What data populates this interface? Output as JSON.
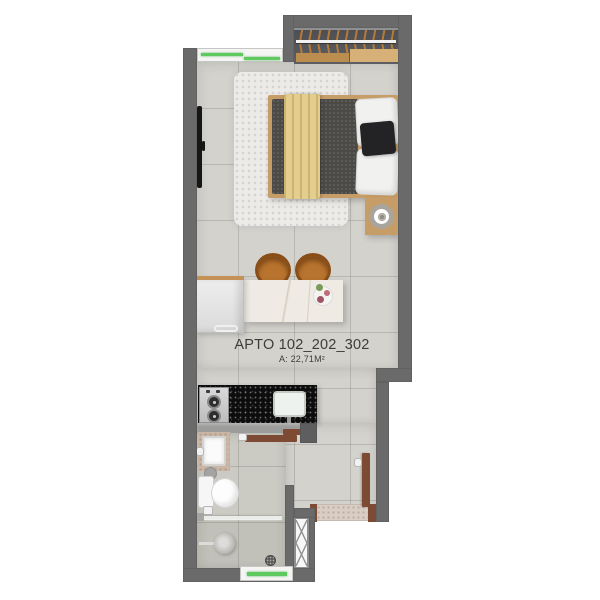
{
  "plan": {
    "type": "apartment-floor-plan",
    "labels": {
      "apartment": "APTO 102_202_302",
      "area": "A: 22,71M²"
    },
    "colors": {
      "wall": "#6a6a6a",
      "floor": "#d4d2cd",
      "bathroom_floor": "#cbcac3",
      "window_glass_green": "#5ec95e",
      "wood_accent": "#c69d66",
      "door_brown": "#7d4b33",
      "countertop_black": "#0d0d0d",
      "blanket_yellow": "#e3ce8e",
      "stool_tan": "#b8742e",
      "label_text": "#3d3d3d"
    },
    "fixtures": [
      "closet-hangers",
      "wardrobe-shelf",
      "top-window",
      "double-bed",
      "yellow-blanket",
      "dark-duvet",
      "pillows",
      "shag-rug",
      "wall-tv",
      "nightstand",
      "table-lamp",
      "bar-stools",
      "kitchen-island",
      "decor-plate",
      "refrigerator",
      "two-burner-cooktop",
      "kitchen-sink",
      "sliding-door",
      "bathroom-sink",
      "toilet",
      "toilet-paper-holder",
      "shower-glass-partition",
      "shower-head",
      "floor-drain",
      "bathroom-window",
      "service-shaft",
      "entrance-door",
      "doormat"
    ]
  }
}
